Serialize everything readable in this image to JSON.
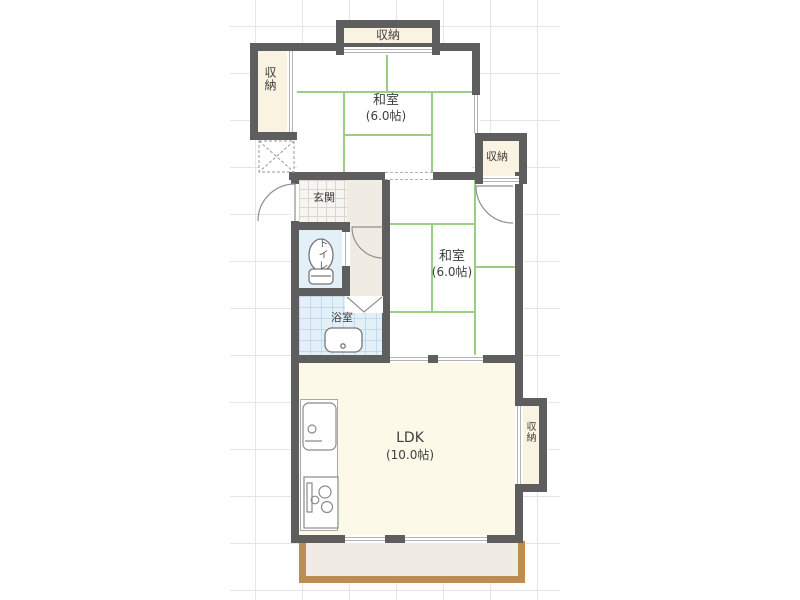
{
  "plan": {
    "labels": {
      "closet_top": "収納",
      "closet_left": "収納",
      "closet_mid": "収納",
      "closet_ldk": "収納",
      "genkan": "玄関",
      "toilet": "トイレ",
      "bath": "浴室",
      "washitsu1_name": "和室",
      "washitsu1_size": "(6.0帖)",
      "washitsu2_name": "和室",
      "washitsu2_size": "(6.0帖)",
      "ldk_name": "LDK",
      "ldk_size": "(10.0帖)"
    },
    "colors": {
      "wall": "#5e5e5e",
      "tatami_line": "#9ccd85",
      "closet_fill": "#faf3e2",
      "ldk_fill": "#fcf9e9",
      "hall_fill": "#f0ece3",
      "wet_area_fill": "#e3f0f8",
      "balcony_border": "#bd8c51",
      "grid_line": "#e5e5e5",
      "text": "#3f3f3f"
    }
  }
}
